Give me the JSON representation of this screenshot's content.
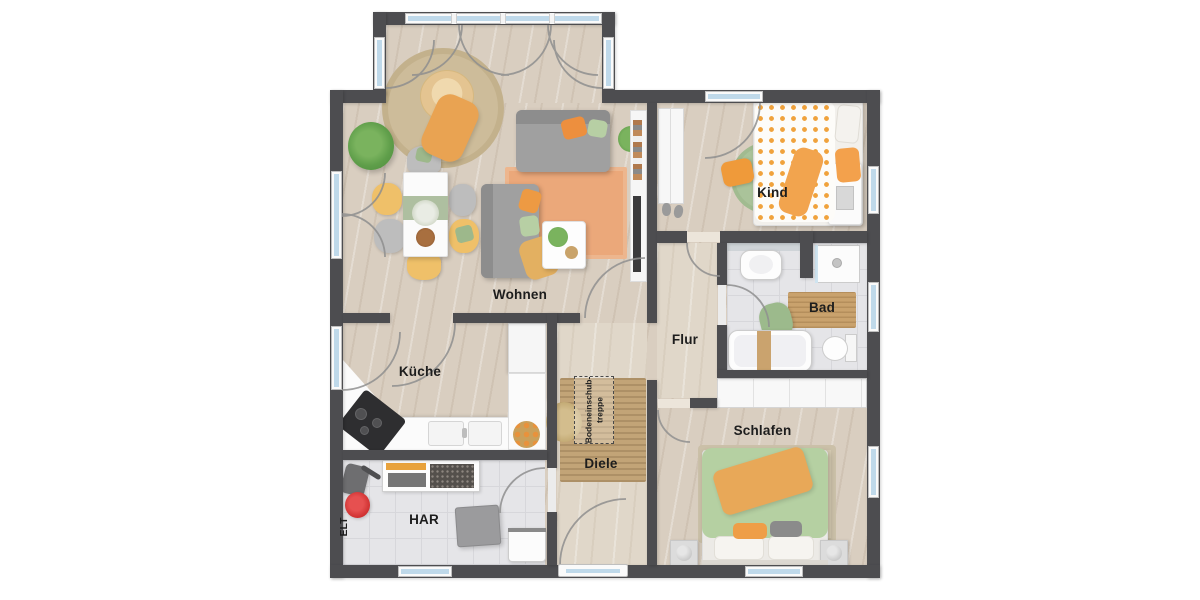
{
  "labels": {
    "wohnen": "Wohnen",
    "kueche": "Küche",
    "flur": "Flur",
    "kind": "Kind",
    "bad": "Bad",
    "schlafen": "Schlafen",
    "diele": "Diele",
    "har": "HAR",
    "elt": "ELT",
    "attic_line1": "Bodeneinschub-",
    "attic_line2": "treppe"
  },
  "legend": {
    "type": "floor-plan",
    "rooms": [
      "Wohnen",
      "Küche",
      "Flur",
      "Kind",
      "Bad",
      "Schlafen",
      "Diele",
      "HAR",
      "ELT"
    ],
    "annotation": "Bodeneinschub-treppe"
  },
  "colors": {
    "wall": "#4d4d50",
    "wood_floor": "#d9cec0",
    "tile_floor": "#e5e5e8",
    "window_glass": "#bfd9ea",
    "accent_orange": "#ed9a43",
    "accent_green": "#b5d0a2",
    "rug_orange": "#eba87a",
    "doormat_jute": "#c2a477",
    "bathmat_wood": "#c9a26d"
  }
}
